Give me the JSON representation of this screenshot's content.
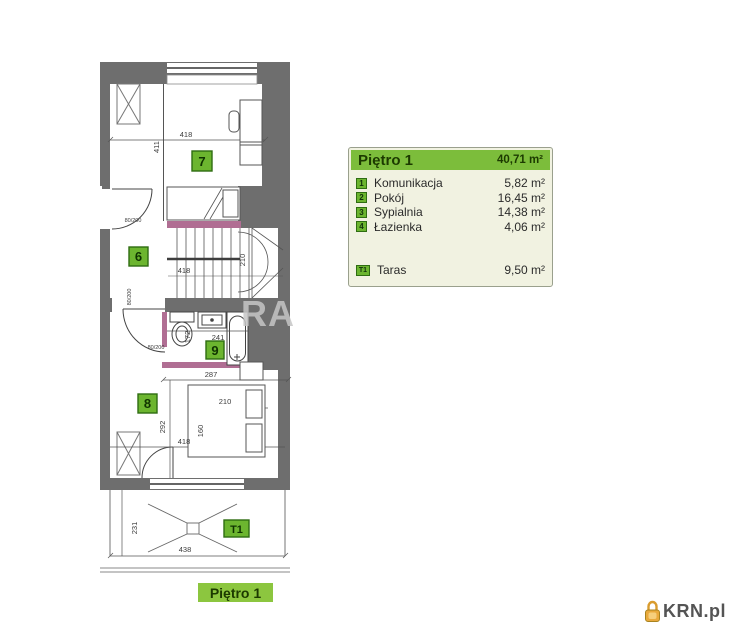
{
  "legend": {
    "title": "Piętro 1",
    "total_area": "40,71 m²",
    "rooms": [
      {
        "no": "1",
        "name": "Komunikacja",
        "area": "5,82 m²"
      },
      {
        "no": "2",
        "name": "Pokój",
        "area": "16,45 m²"
      },
      {
        "no": "3",
        "name": "Sypialnia",
        "area": "14,38 m²"
      },
      {
        "no": "4",
        "name": "Łazienka",
        "area": "4,06 m²"
      }
    ],
    "extra": {
      "no": "T1",
      "name": "Taras",
      "area": "9,50 m²"
    }
  },
  "plan": {
    "room_labels": {
      "r6": "6",
      "r7": "7",
      "r8": "8",
      "r9": "9",
      "t1": "T1"
    },
    "dims": {
      "w418a": "418",
      "h411": "411",
      "s418": "418",
      "s210": "210",
      "b241": "241",
      "b172": "172",
      "r287": "287",
      "r210": "210",
      "r160": "160",
      "r292": "292",
      "r418": "418",
      "t231": "231",
      "t438": "438",
      "door_a": "80/200",
      "door_b": "80/200",
      "door_c": "80/200"
    },
    "watermark": "RA"
  },
  "footer": {
    "floor_label": "Piętro 1"
  },
  "logo": {
    "text": "KRN.pl"
  },
  "colors": {
    "accent_green": "#7cbd3b",
    "badge_green": "#6cb52f",
    "wall_gray": "#6e6e6e",
    "pink_wall": "#b06e93",
    "table_bg": "#f1f2e1",
    "logo_orange": "#e9a93c"
  }
}
